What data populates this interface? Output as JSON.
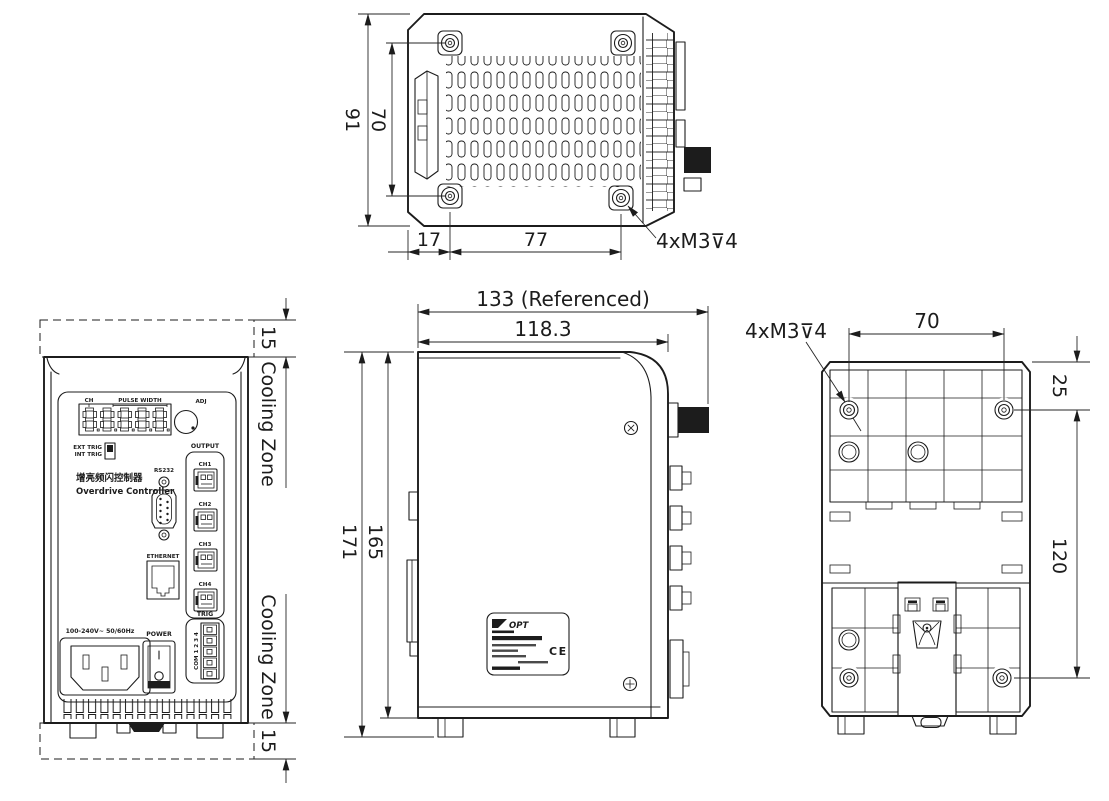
{
  "views": {
    "top": {
      "dim_outer_height": "91",
      "dim_hole_height": "70",
      "dim_left_offset": "17",
      "dim_hole_span": "77",
      "screw_callout": "4xM3⊽4"
    },
    "front": {
      "cooling_gap": "15",
      "cooling_zone_label": "Cooling Zone",
      "display": {
        "ch": "CH",
        "pulse_width": "PULSE WIDTH"
      },
      "adj_label": "ADJ",
      "ext_trig_label": "EXT TRIG",
      "int_trig_label": "INT TRIG",
      "title_cn": "增亮频闪控制器",
      "title_en": "Overdrive Controller",
      "rs232_label": "RS232",
      "ethernet_label": "ETHERNET",
      "output_label": "OUTPUT",
      "channels": {
        "ch1": "CH1",
        "ch2": "CH2",
        "ch3": "CH3",
        "ch4": "CH4"
      },
      "trig_label": "TRIG",
      "trig_pins_label": "COM 1 2 3 4",
      "power_rating": "100-240V~ 50/60Hz",
      "power_label": "POWER"
    },
    "side": {
      "dim_overall_width": "133 (Referenced)",
      "dim_body_width": "118.3",
      "dim_overall_height": "171",
      "dim_body_height": "165",
      "label_brand": "OPT",
      "label_ce": "CE"
    },
    "back": {
      "screw_callout": "4xM3⊽4",
      "dim_hole_span": "70",
      "dim_top_offset": "25",
      "dim_hole_height": "120"
    }
  },
  "colors": {
    "line": "#1c1c1c",
    "paper": "#ffffff"
  }
}
